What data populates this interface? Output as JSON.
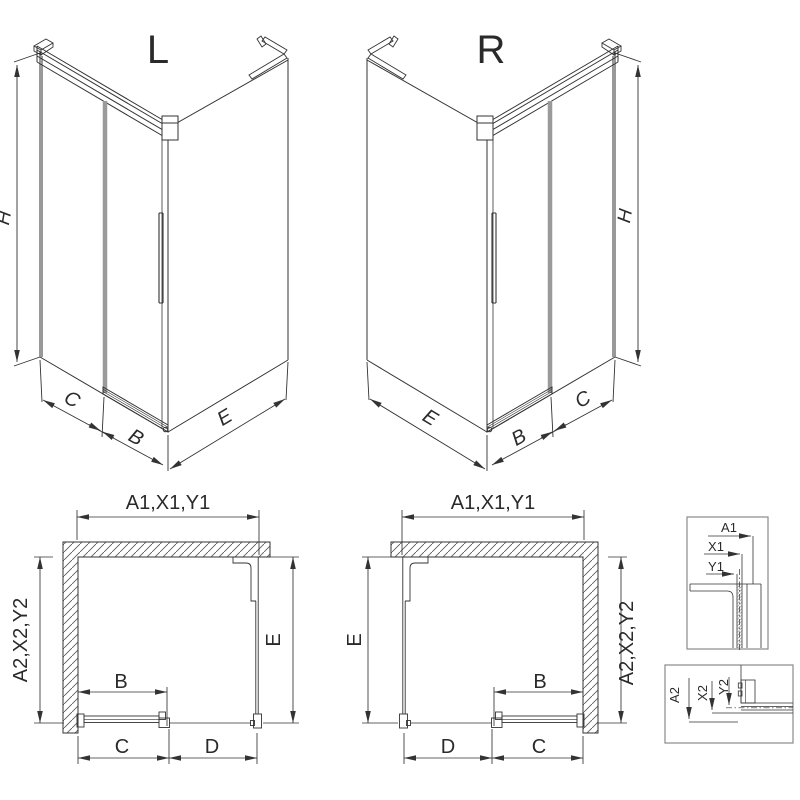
{
  "views": {
    "iso_left": {
      "title": "L"
    },
    "iso_right": {
      "title": "R"
    }
  },
  "dims": {
    "height": "H",
    "door_panel_width": "B",
    "door_travel": "C",
    "opening_width": "D",
    "side_panel_depth": "E",
    "width_group": "A1,X1,Y1",
    "depth_group": "A2,X2,Y2",
    "a1": "A1",
    "x1": "X1",
    "y1": "Y1",
    "a2": "A2",
    "x2": "X2",
    "y2": "Y2"
  },
  "colors": {
    "line": "#333333",
    "frame": "#8a8a8a",
    "glass_edge": "#9a9a9a",
    "hatch": "#606060",
    "background": "#ffffff"
  }
}
